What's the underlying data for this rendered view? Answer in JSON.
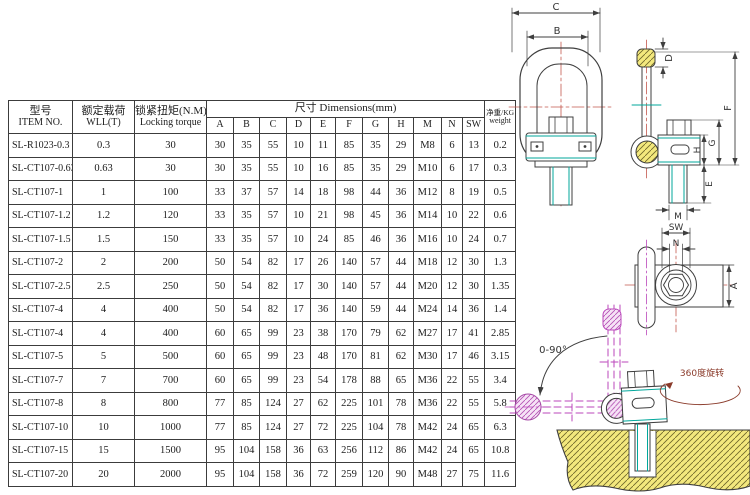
{
  "table": {
    "header": {
      "item_cn": "型号",
      "item_en": "ITEM NO.",
      "wll_cn": "额定载荷",
      "wll_en": "WLL(T)",
      "torque_cn": "锁紧扭矩(N.M)",
      "torque_en": "Locking torque",
      "dims_title": "尺寸  Dimensions(mm)",
      "dim_cols": [
        "A",
        "B",
        "C",
        "D",
        "E",
        "F",
        "G",
        "H",
        "M",
        "N",
        "SW"
      ],
      "weight_cn": "净重/KG",
      "weight_en": "weight"
    },
    "rows": [
      {
        "item": "SL-R1023-0.3",
        "wll": "0.3",
        "torque": "30",
        "dims": [
          "30",
          "35",
          "55",
          "10",
          "11",
          "85",
          "35",
          "29",
          "M8",
          "6",
          "13"
        ],
        "weight": "0.2"
      },
      {
        "item": "SL-CT107-0.63",
        "wll": "0.63",
        "torque": "30",
        "dims": [
          "30",
          "35",
          "55",
          "10",
          "16",
          "85",
          "35",
          "29",
          "M10",
          "6",
          "17"
        ],
        "weight": "0.3"
      },
      {
        "item": "SL-CT107-1",
        "wll": "1",
        "torque": "100",
        "dims": [
          "33",
          "37",
          "57",
          "14",
          "18",
          "98",
          "44",
          "36",
          "M12",
          "8",
          "19"
        ],
        "weight": "0.5"
      },
      {
        "item": "SL-CT107-1.2",
        "wll": "1.2",
        "torque": "120",
        "dims": [
          "33",
          "35",
          "57",
          "10",
          "21",
          "98",
          "45",
          "36",
          "M14",
          "10",
          "22"
        ],
        "weight": "0.6"
      },
      {
        "item": "SL-CT107-1.5",
        "wll": "1.5",
        "torque": "150",
        "dims": [
          "33",
          "35",
          "57",
          "10",
          "24",
          "85",
          "46",
          "36",
          "M16",
          "10",
          "24"
        ],
        "weight": "0.7"
      },
      {
        "item": "SL-CT107-2",
        "wll": "2",
        "torque": "200",
        "dims": [
          "50",
          "54",
          "82",
          "17",
          "26",
          "140",
          "57",
          "44",
          "M18",
          "12",
          "30"
        ],
        "weight": "1.3"
      },
      {
        "item": "SL-CT107-2.5",
        "wll": "2.5",
        "torque": "250",
        "dims": [
          "50",
          "54",
          "82",
          "17",
          "30",
          "140",
          "57",
          "44",
          "M20",
          "12",
          "30"
        ],
        "weight": "1.35"
      },
      {
        "item": "SL-CT107-4",
        "wll": "4",
        "torque": "400",
        "dims": [
          "50",
          "54",
          "82",
          "17",
          "36",
          "140",
          "59",
          "44",
          "M24",
          "14",
          "36"
        ],
        "weight": "1.4"
      },
      {
        "item": "SL-CT107-4",
        "wll": "4",
        "torque": "400",
        "dims": [
          "60",
          "65",
          "99",
          "23",
          "38",
          "170",
          "79",
          "62",
          "M27",
          "17",
          "41"
        ],
        "weight": "2.85"
      },
      {
        "item": "SL-CT107-5",
        "wll": "5",
        "torque": "500",
        "dims": [
          "60",
          "65",
          "99",
          "23",
          "48",
          "170",
          "81",
          "62",
          "M30",
          "17",
          "46"
        ],
        "weight": "3.15"
      },
      {
        "item": "SL-CT107-7",
        "wll": "7",
        "torque": "700",
        "dims": [
          "60",
          "65",
          "99",
          "23",
          "54",
          "178",
          "88",
          "65",
          "M36",
          "22",
          "55"
        ],
        "weight": "3.4"
      },
      {
        "item": "SL-CT107-8",
        "wll": "8",
        "torque": "800",
        "dims": [
          "77",
          "85",
          "124",
          "27",
          "62",
          "225",
          "101",
          "78",
          "M36",
          "22",
          "55"
        ],
        "weight": "5.8"
      },
      {
        "item": "SL-CT107-10",
        "wll": "10",
        "torque": "1000",
        "dims": [
          "77",
          "85",
          "124",
          "27",
          "72",
          "225",
          "104",
          "78",
          "M42",
          "24",
          "65"
        ],
        "weight": "6.3"
      },
      {
        "item": "SL-CT107-15",
        "wll": "15",
        "torque": "1500",
        "dims": [
          "95",
          "104",
          "158",
          "36",
          "63",
          "256",
          "112",
          "86",
          "M42",
          "24",
          "65"
        ],
        "weight": "10.8"
      },
      {
        "item": "SL-CT107-20",
        "wll": "20",
        "torque": "2000",
        "dims": [
          "95",
          "104",
          "158",
          "36",
          "72",
          "259",
          "120",
          "90",
          "M48",
          "27",
          "75"
        ],
        "weight": "11.6"
      }
    ]
  },
  "drawing": {
    "labels": {
      "c": "C",
      "b": "B",
      "d": "D",
      "f": "F",
      "g": "G",
      "h": "H",
      "e": "E",
      "m": "M",
      "sw": "SW",
      "n": "N",
      "a": "A",
      "swing": "0-90°",
      "rotation": "360度旋转"
    },
    "colors": {
      "line": "#3f3f3f",
      "teal": "#00a79b",
      "magenta": "#bb47bb",
      "hatch_yellow": "#f3e87d",
      "centerline_red": "#c4574d",
      "annotation_red": "#8a3a2a"
    }
  }
}
